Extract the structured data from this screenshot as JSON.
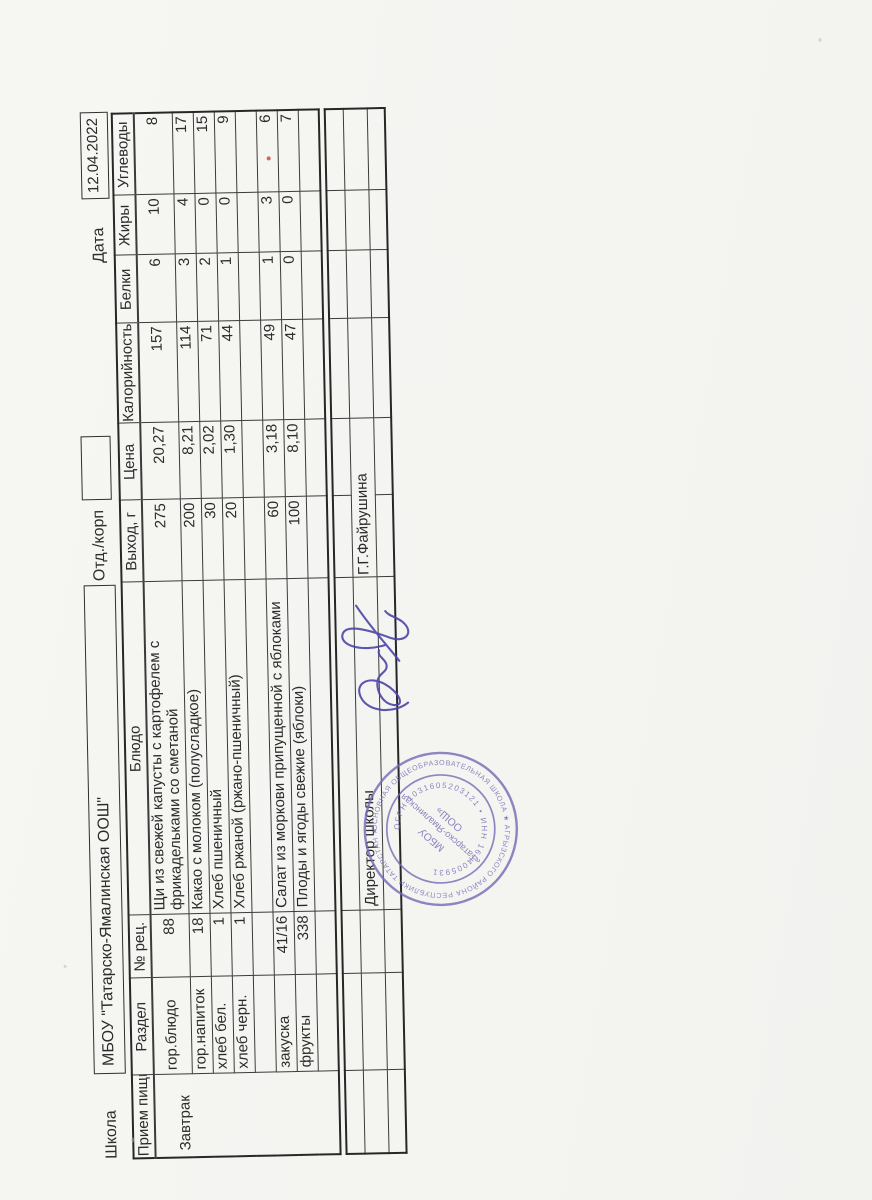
{
  "header": {
    "school_label": "Школа",
    "school_name": "МБОУ \"Татарско-Ямалинская ООШ\"",
    "dept_label": "Отд./корп",
    "date_label": "Дата",
    "date_value": "12.04.2022"
  },
  "table": {
    "headers": [
      "Прием пищи",
      "Раздел",
      "№ рец.",
      "Блюдо",
      "Выход, г",
      "Цена",
      "Калорийность",
      "Белки",
      "Жиры",
      "Углеводы"
    ],
    "meal": "Завтрак",
    "rows": [
      {
        "section": "гор.блюдо",
        "rec": "88",
        "dish": "Щи из свежей капусты с картофелем с\nфрикадельками со сметаной",
        "out": "275",
        "price": "20,27",
        "cal": "157",
        "protein": "6",
        "fat": "10",
        "carbs": "8"
      },
      {
        "section": "гор.напиток",
        "rec": "18",
        "dish": "Какао с молоком (полусладкое)",
        "out": "200",
        "price": "8,21",
        "cal": "114",
        "protein": "3",
        "fat": "4",
        "carbs": "17"
      },
      {
        "section": "хлеб бел.",
        "rec": "1",
        "dish": "Хлеб пшеничный",
        "out": "30",
        "price": "2,02",
        "cal": "71",
        "protein": "2",
        "fat": "0",
        "carbs": "15"
      },
      {
        "section": "хлеб черн.",
        "rec": "1",
        "dish": "Хлеб ржаной (ржано-пшеничный)",
        "out": "20",
        "price": "1,30",
        "cal": "44",
        "protein": "1",
        "fat": "0",
        "carbs": "9"
      },
      {
        "section": "",
        "rec": "",
        "dish": "",
        "out": "",
        "price": "",
        "cal": "",
        "protein": "",
        "fat": "",
        "carbs": ""
      },
      {
        "section": "закуска",
        "rec": "41/16",
        "dish": "Салат из моркови припущенной с яблоками",
        "out": "60",
        "price": "3,18",
        "cal": "49",
        "protein": "1",
        "fat": "3",
        "carbs": "6"
      },
      {
        "section": "фрукты",
        "rec": "338",
        "dish": "Плоды и ягоды свежие (яблоки)",
        "out": "100",
        "price": "8,10",
        "cal": "47",
        "protein": "0",
        "fat": "0",
        "carbs": "7"
      },
      {
        "section": "",
        "rec": "",
        "dish": "",
        "out": "",
        "price": "",
        "cal": "",
        "protein": "",
        "fat": "",
        "carbs": ""
      }
    ]
  },
  "footer": {
    "director_label": "Директор школы",
    "director_name": "Г.Г.Файрушина"
  },
  "stamp": {
    "outer_ring": "ОСНОВНАЯ ОБЩЕОБРАЗОВАТЕЛЬНАЯ ШКОЛА ★ АГРЫЗСКОГО РАЙОНА РЕСПУБЛИКИ ТАТАРСТАН ★",
    "inner_ring": "ОГРН 1031605203121 • ИНН 1604005931",
    "center_line1": "МБОУ",
    "center_line2": "«Татарско-Ямалинская",
    "center_line3": "ООШ»",
    "ink_color": "#7668b4"
  },
  "signature": {
    "ink_color": "#4c46a8"
  },
  "scan_marks": {
    "red_dot_color": "#c0392b"
  }
}
